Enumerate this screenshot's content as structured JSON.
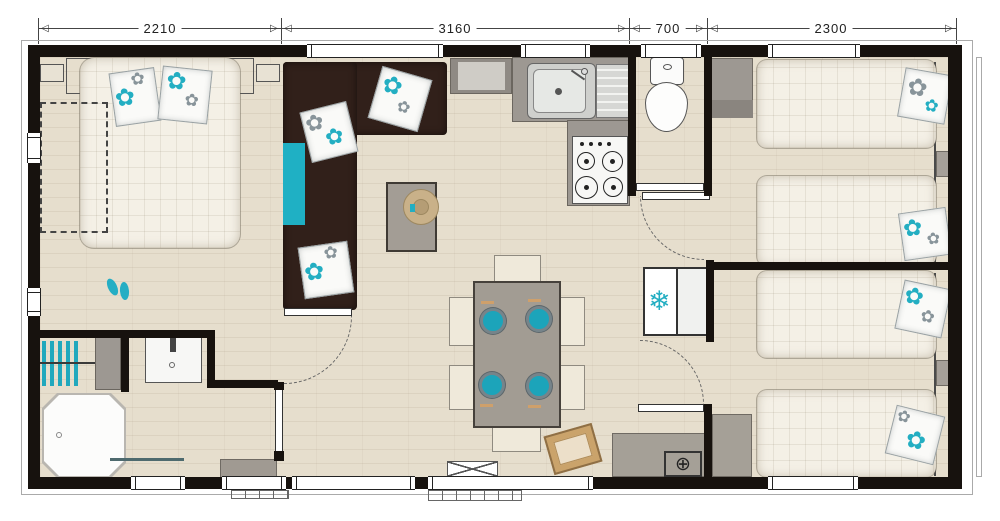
{
  "plan": {
    "dimensions": [
      {
        "label": "2210"
      },
      {
        "label": "3160"
      },
      {
        "label": "700"
      },
      {
        "label": "2300"
      }
    ],
    "icons": {
      "arrow_left": "◁",
      "arrow_right": "▷",
      "flower": "✿",
      "snowflake": "❄",
      "water_heater": "⊕"
    },
    "colors": {
      "accent_teal": "#23aec2",
      "sofa_brown": "#31201a",
      "wall_black": "#17120e",
      "counter_gray": "#9d9892",
      "floor_beige": "#e6decd",
      "mattress_cream": "#f4f0e6"
    }
  }
}
